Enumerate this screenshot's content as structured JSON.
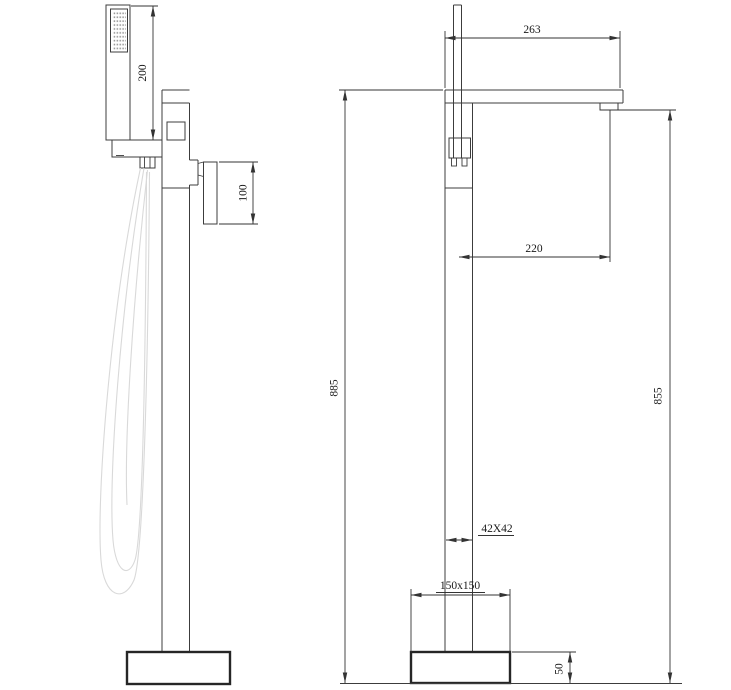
{
  "drawing": {
    "type": "technical-dimension-drawing",
    "views": [
      "side-view",
      "front-view"
    ],
    "colors": {
      "outline": "#3c3c3c",
      "dimension_line": "#333333",
      "base_outline": "#262626",
      "hose": "#d9d9d9",
      "spray_dots": "#9a9a9a",
      "text": "#1a1a1a",
      "background": "#ffffff"
    }
  },
  "dimensions": {
    "shower_length": {
      "label": "200"
    },
    "handle_height": {
      "label": "100"
    },
    "spout_reach_total": {
      "label": "263"
    },
    "spout_reach_center": {
      "label": "220"
    },
    "total_height": {
      "label": "885"
    },
    "spout_height": {
      "label": "855"
    },
    "column_section": {
      "label": "42X42"
    },
    "base_size": {
      "label": "150x150"
    },
    "base_height": {
      "label": "50"
    }
  }
}
